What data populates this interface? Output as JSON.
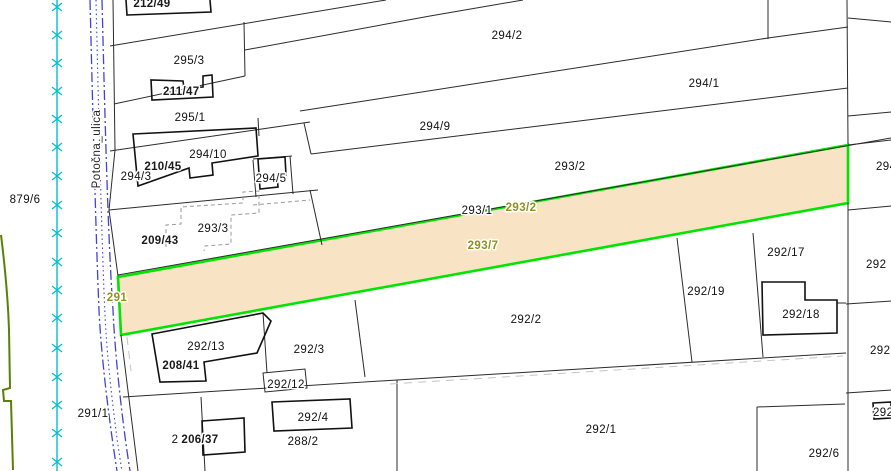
{
  "map": {
    "street": {
      "name": "Potočna_ulica"
    },
    "colors": {
      "selected_fill": "#f8e3c4",
      "selected_border": "#00e400",
      "label_olive": "#90911f",
      "label_red": "#dd0000",
      "street_blue": "#4343d9",
      "survey_cyan": "#00bfcf",
      "left_boundary_green": "#5c7f0a"
    },
    "parcel_labels": [
      "879/6",
      "295/3",
      "295/1",
      "294/3",
      "294/10",
      "294/5",
      "293/3",
      "294/2",
      "294/9",
      "294/1",
      "293/2",
      "293/1",
      "292/13",
      "292/3",
      "292/12",
      "292/2",
      "292/19",
      "292/17",
      "292/18",
      "291/1",
      "292/4",
      "288/2",
      "292/1",
      "292/6",
      "2",
      "294",
      "292",
      "292",
      "292"
    ],
    "selected_labels": [
      "293/2",
      "293/7",
      "291"
    ],
    "building_labels": [
      {
        "num": "212/",
        "red": "49"
      },
      {
        "num": "211/",
        "red": "47"
      },
      {
        "num": "210/",
        "red": "45"
      },
      {
        "num": "209/",
        "red": "43"
      },
      {
        "num": "208/",
        "red": "41"
      },
      {
        "num": "206/",
        "red": "37"
      }
    ]
  }
}
